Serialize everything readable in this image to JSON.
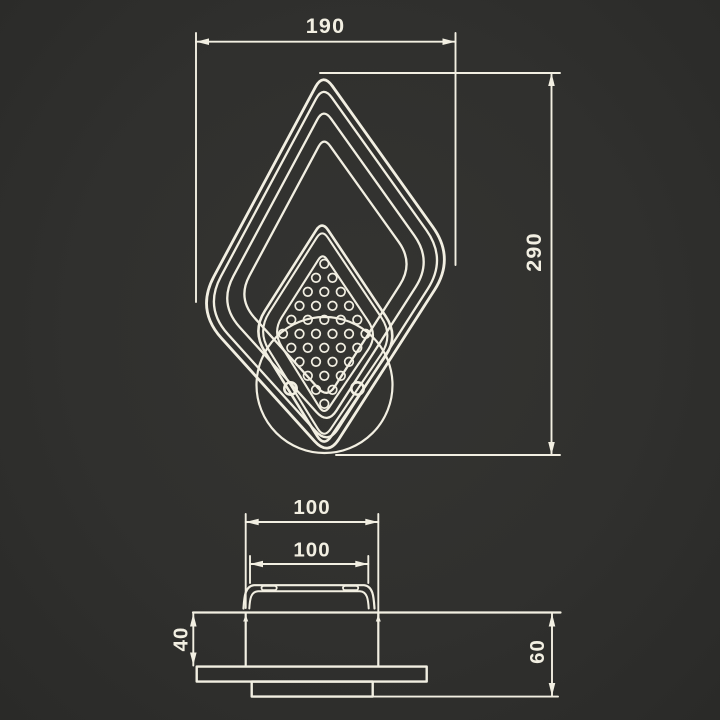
{
  "front_view": {
    "width_label": "190",
    "height_label": "290"
  },
  "side_view": {
    "body_width_label": "100",
    "bracket_width_label": "100",
    "inset_depth_label": "40",
    "total_depth_label": "60"
  },
  "colors": {
    "background": "#30302e",
    "line": "#f2efe2"
  },
  "icons": {
    "front_shape": "nested-rounded-diamond-lamp-outline",
    "mount": "wall-mount-circle",
    "fasteners": "screw-holes",
    "panel": "perforated-dot-panel"
  }
}
